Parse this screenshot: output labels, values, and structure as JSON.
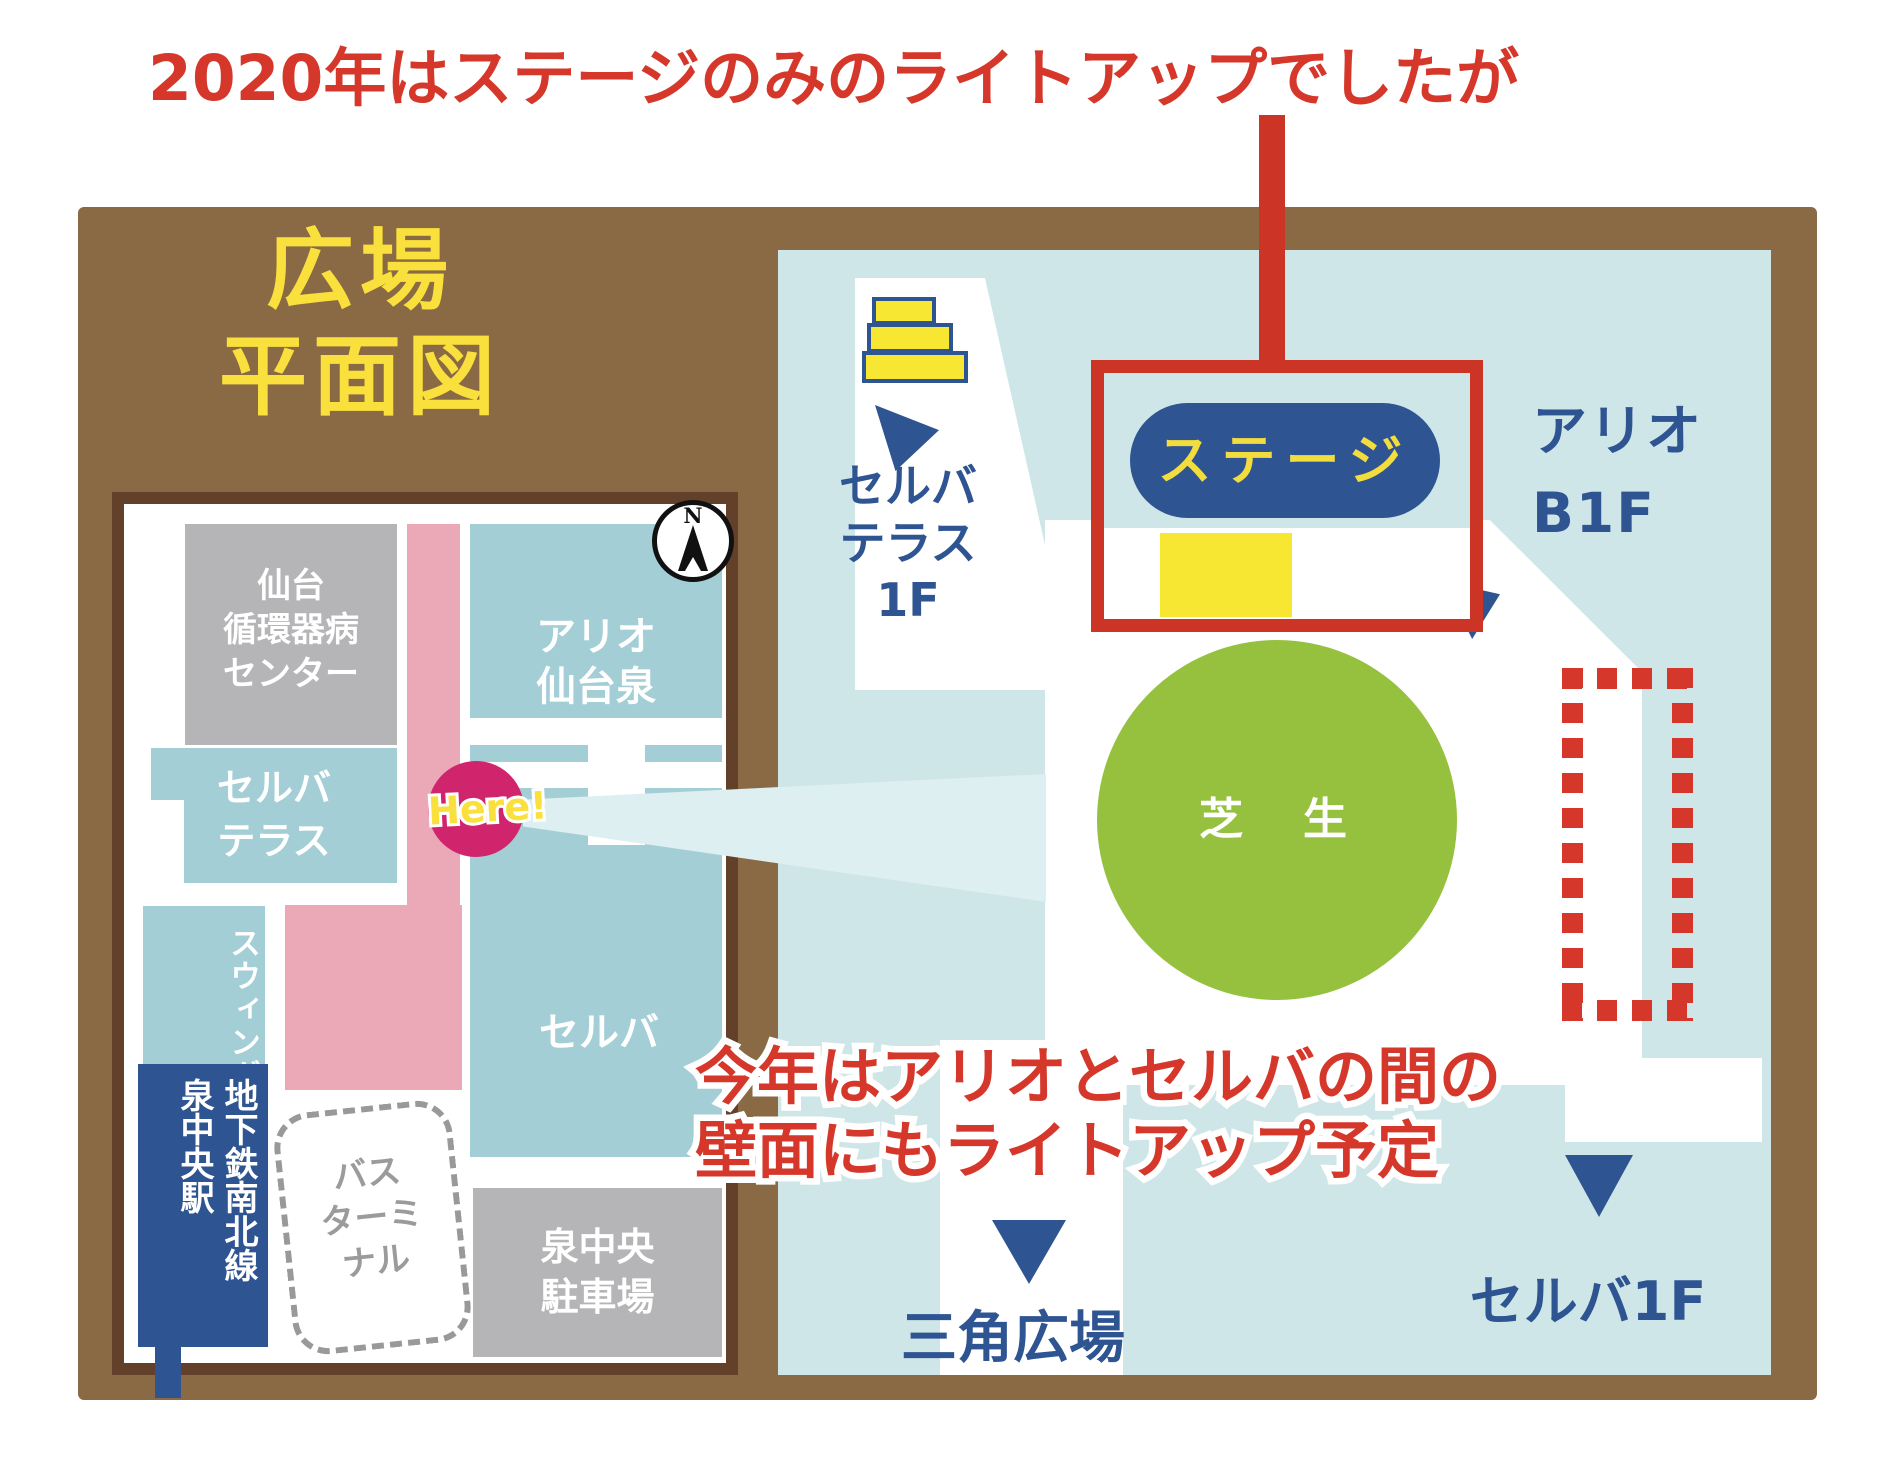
{
  "annotation": {
    "top": "2020年はステージのみのライトアップでしたが",
    "bottom": "今年はアリオとセルバの間の\n壁面にもライトアップ予定"
  },
  "legend_title": "広場\n平面図",
  "left_map": {
    "hospital": "仙台\n循環器病\nセンター",
    "ario_izumi": "アリオ\n仙台泉",
    "selva_terrace": "セルバ\nテラス",
    "here": "Here!",
    "swing": "スウィング",
    "subway_station": "地下鉄南北線\n泉中央駅",
    "bus_terminal": "バス\nターミ\nナル",
    "selva": "セルバ",
    "parking": "泉中央\n駐車場",
    "compass_north": "N"
  },
  "right_map": {
    "selva_terrace_1f": "セルバ\nテラス\n1F",
    "stage": "ステージ",
    "ario_b1f": "アリオ\nB1F",
    "lawn": "芝　生",
    "sankaku_plaza": "三角広場",
    "selva_1f": "セルバ1F"
  },
  "colors": {
    "accent_red": "#d5372b",
    "frame_brown": "#8a6a44",
    "map_border_brown": "#63402a",
    "map_blue": "#cfe6e8",
    "block_teal": "#a3ced6",
    "block_gray": "#b5b5b7",
    "path_pink": "#eba9b8",
    "here_crimson": "#d0256d",
    "label_navy": "#2e5491",
    "lawn_green": "#96c13e",
    "stage_yellow": "#f7e733",
    "title_yellow": "#fae03c"
  }
}
